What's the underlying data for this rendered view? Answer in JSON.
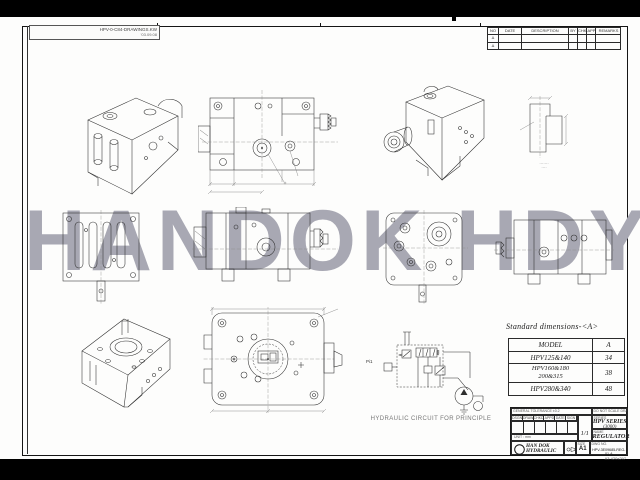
{
  "sheet": {
    "watermark": "HANDOK HDY",
    "corner_label_line1": "HPV-0-C84-DRAWINGS.KW",
    "corner_label_line2": "'03.09.08",
    "footer_note": "A3 420x297"
  },
  "revision": {
    "col_no": "NO",
    "col_date": "DATE",
    "col_desc": "DESCRIPTION",
    "col_by": "BY",
    "col_chk": "CHK",
    "col_app": "APP",
    "col_remarks": "REMARKS",
    "rows": [
      {
        "no": "Δ"
      },
      {
        "no": "Δ"
      }
    ]
  },
  "standard_dimensions": {
    "title": "Standard dimensions-<A>",
    "col_model": "MODEL",
    "col_a": "A",
    "rows": [
      {
        "model1": "HPV125&140",
        "model2": "",
        "a": "34"
      },
      {
        "model1": "HPV160&180",
        "model2": "200&315",
        "a": "38"
      },
      {
        "model1": "HPV280&340",
        "model2": "",
        "a": "48"
      }
    ]
  },
  "circuit": {
    "caption": "HYDRAULIC CIRCUIT FOR PRINCIPLE",
    "port_label": "Pi1"
  },
  "detail_view": {
    "note1": "·······",
    "note2": "····"
  },
  "title_block": {
    "top_note_left": "GENERAL TOLERANCE ±0.2",
    "top_note_right": "DO NOT SCALE DRAWING",
    "sig_headers": [
      "DSGN",
      "DRAW",
      "CHKD",
      "APPD",
      "DATE",
      "SIGN"
    ],
    "sig_footer": "UNIT : mm",
    "scale": "1/1",
    "series_tag": "SERIES",
    "series": "HPV SERIES",
    "series_sub": "(3000)",
    "name_tag": "NAME",
    "part_name": "REGULATOR",
    "company_line1": "HAN DOK",
    "company_line2": "HYDRAULIC",
    "size_tag": "SIZE",
    "size": "A1",
    "dwg_tag": "DWG NO.",
    "drawing_no": "HPV-3E09685-REG-01-A"
  }
}
